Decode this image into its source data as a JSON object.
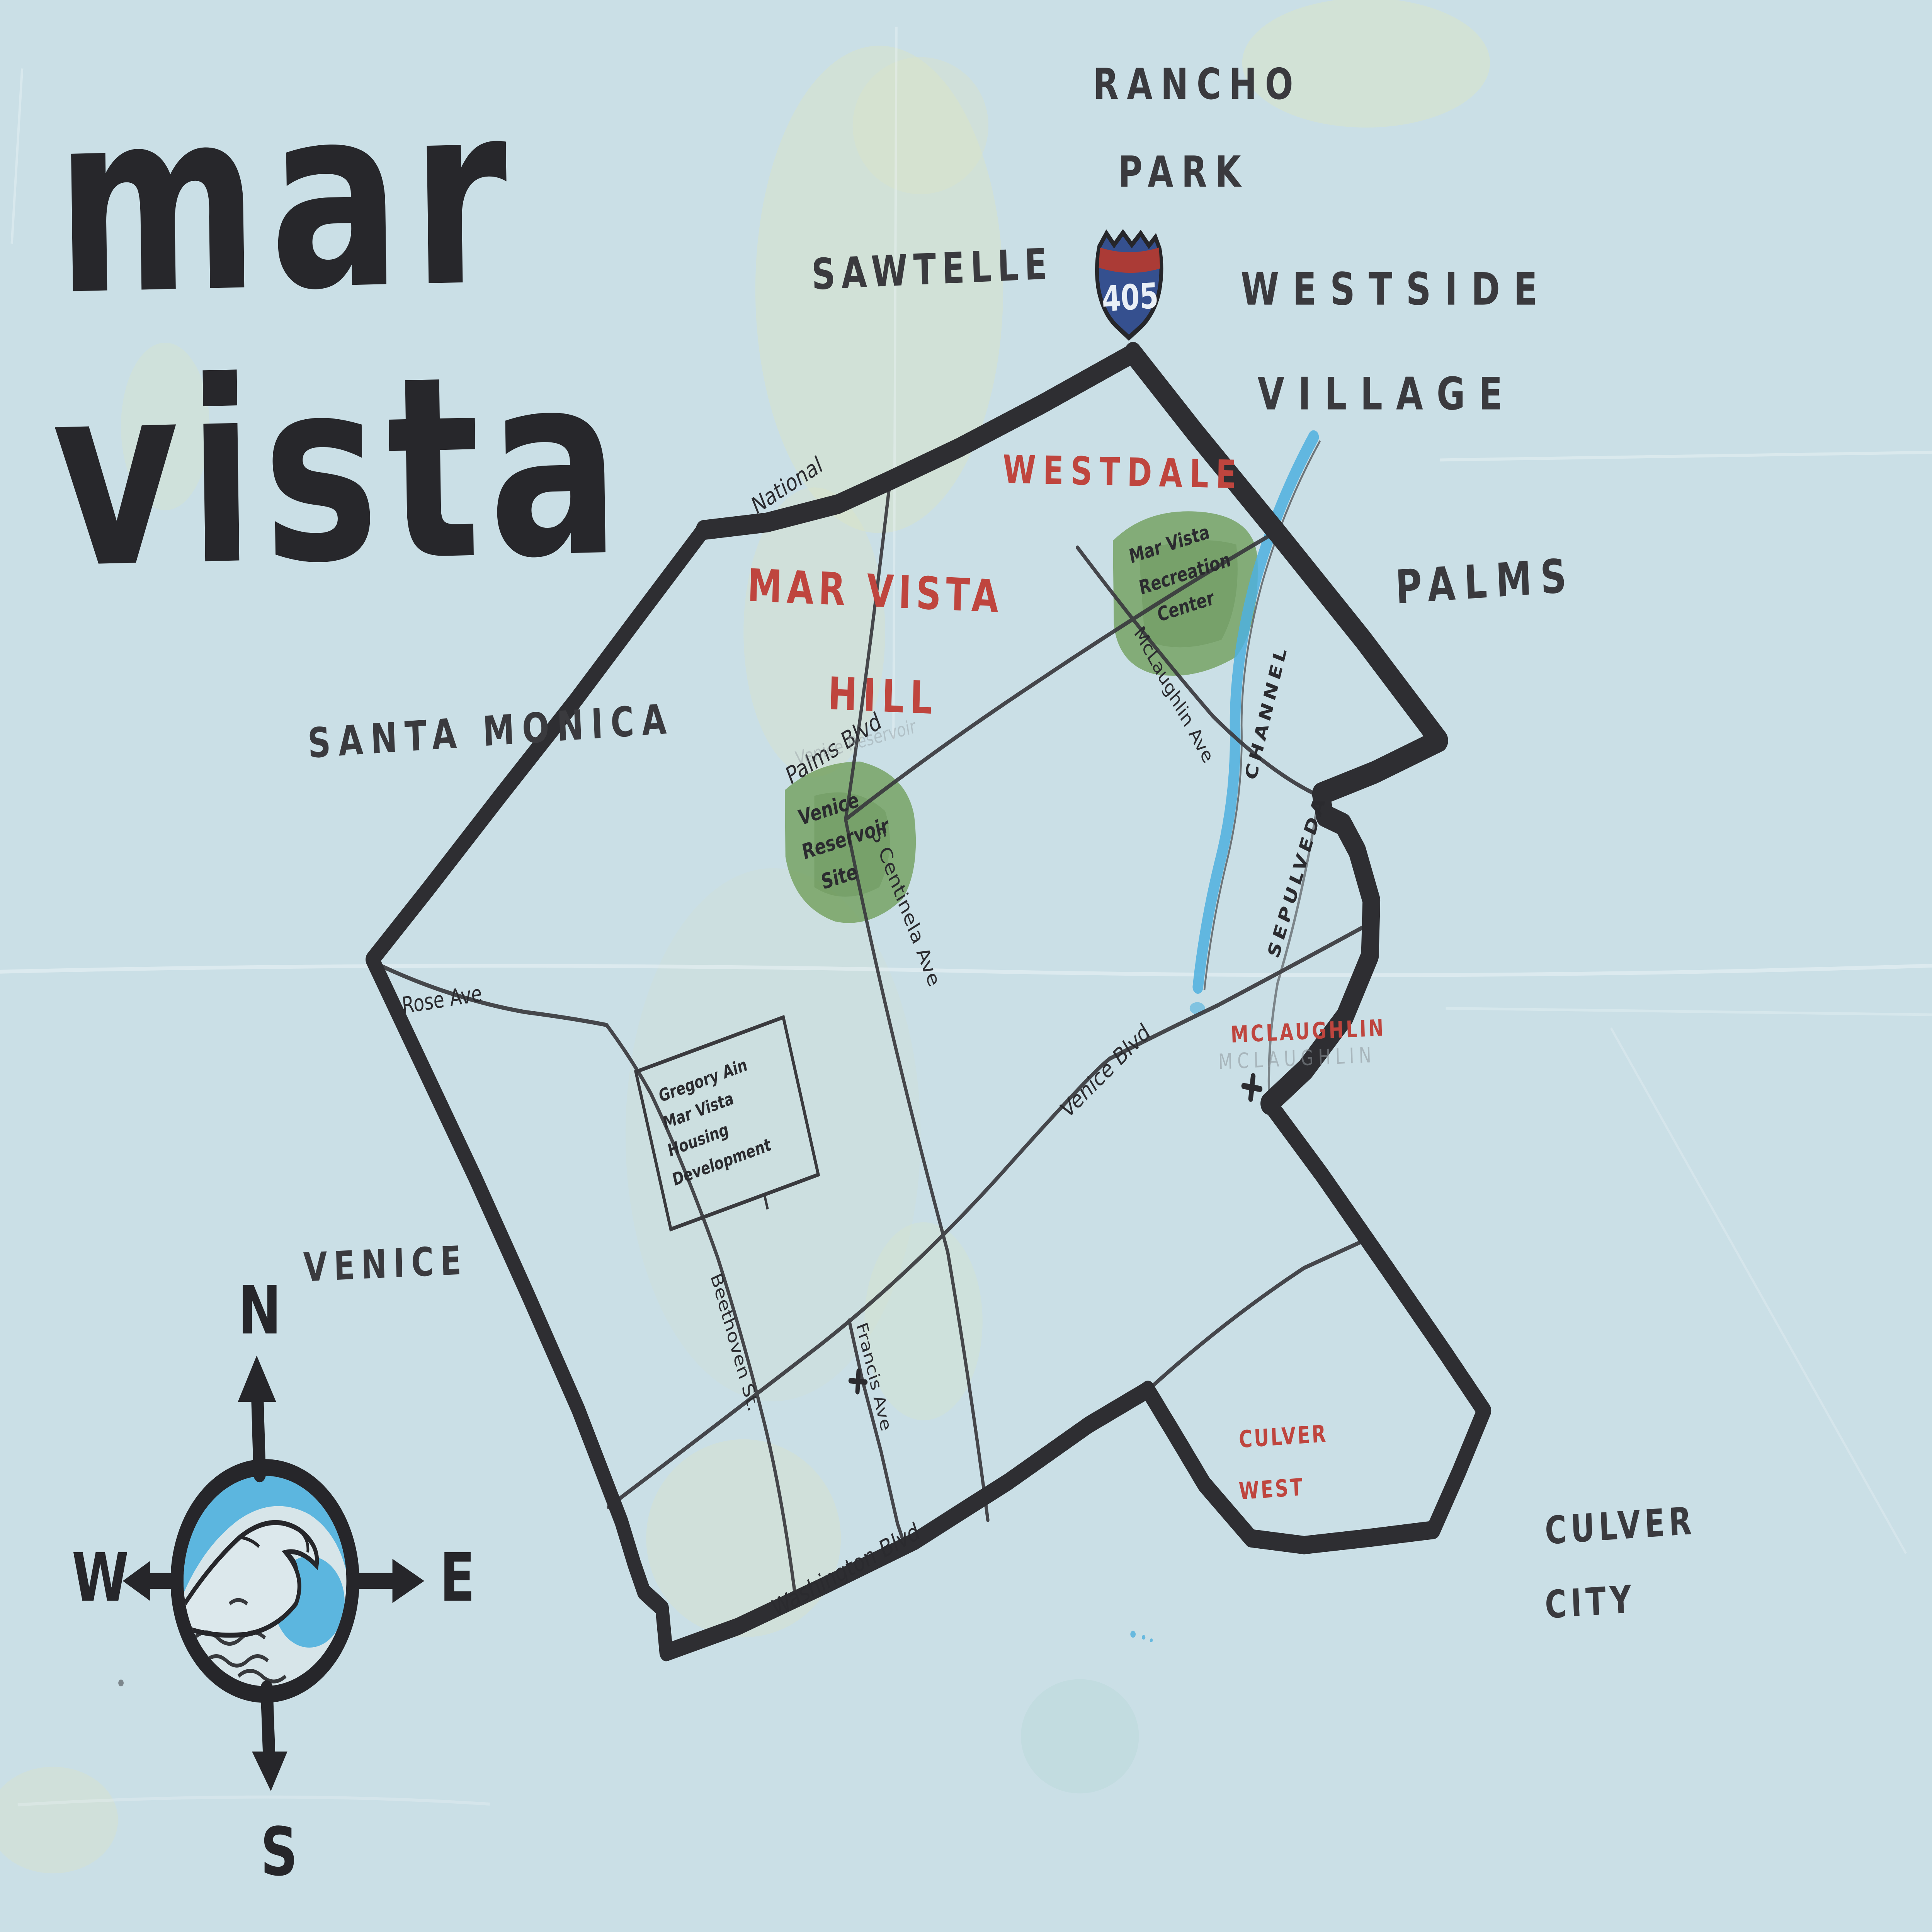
{
  "title": {
    "line1": "mar",
    "line2": "vista"
  },
  "shield": {
    "route": "405"
  },
  "compass": {
    "north": "N",
    "south": "S",
    "east": "E",
    "west": "W"
  },
  "neighborhoods_outside": {
    "rancho_park": {
      "line1": "RANCHO",
      "line2": "PARK"
    },
    "westside_village": {
      "line1": "WESTSIDE",
      "line2": "VILLAGE"
    },
    "sawtelle": "SAWTELLE",
    "palms": "PALMS",
    "santa_monica": "SANTA MONICA",
    "venice": "VENICE",
    "culver_city": {
      "line1": "CULVER",
      "line2": "CITY"
    }
  },
  "districts_inside": {
    "westdale": "WESTDALE",
    "mar_vista_hill": {
      "line1": "MAR VISTA",
      "line2": "HILL"
    },
    "mclaughlin": "MCLAUGHLIN",
    "mclaughlin_pencil": "MCLAUGHLIN",
    "culver_west": {
      "line1": "CULVER",
      "line2": "WEST"
    }
  },
  "streets": {
    "national": "National",
    "palms_blvd": "Palms Blvd",
    "rose_ave": "Rose Ave",
    "centinela": "S Centinela Ave",
    "venice_blvd": "Venice Blvd",
    "mclaughlin_ave": "McLaughlin Ave",
    "beethoven": "Beethoven St.",
    "francis": "Francis Ave",
    "washington": "Washington Blvd"
  },
  "landmarks": {
    "venice_reservoir": {
      "line1": "Venice",
      "line2": "Reservoir",
      "line3": "Site"
    },
    "venice_reservoir_pencil": "Venice Reservoir",
    "rec_center": {
      "line1": "Mar Vista",
      "line2": "Recreation",
      "line3": "Center"
    },
    "housing": {
      "line1": "Gregory Ain",
      "line2": "Mar Vista",
      "line3": "Housing",
      "line4": "Development"
    },
    "channel": {
      "word1": "SEPULVEDA",
      "word2": "CHANNEL"
    }
  },
  "colors": {
    "paper": "#cadfe6",
    "ink": "#2e2e32",
    "red": "#bf453e",
    "green": "#6f9e58",
    "water": "#4fb0de",
    "pencil": "#8e959a"
  }
}
